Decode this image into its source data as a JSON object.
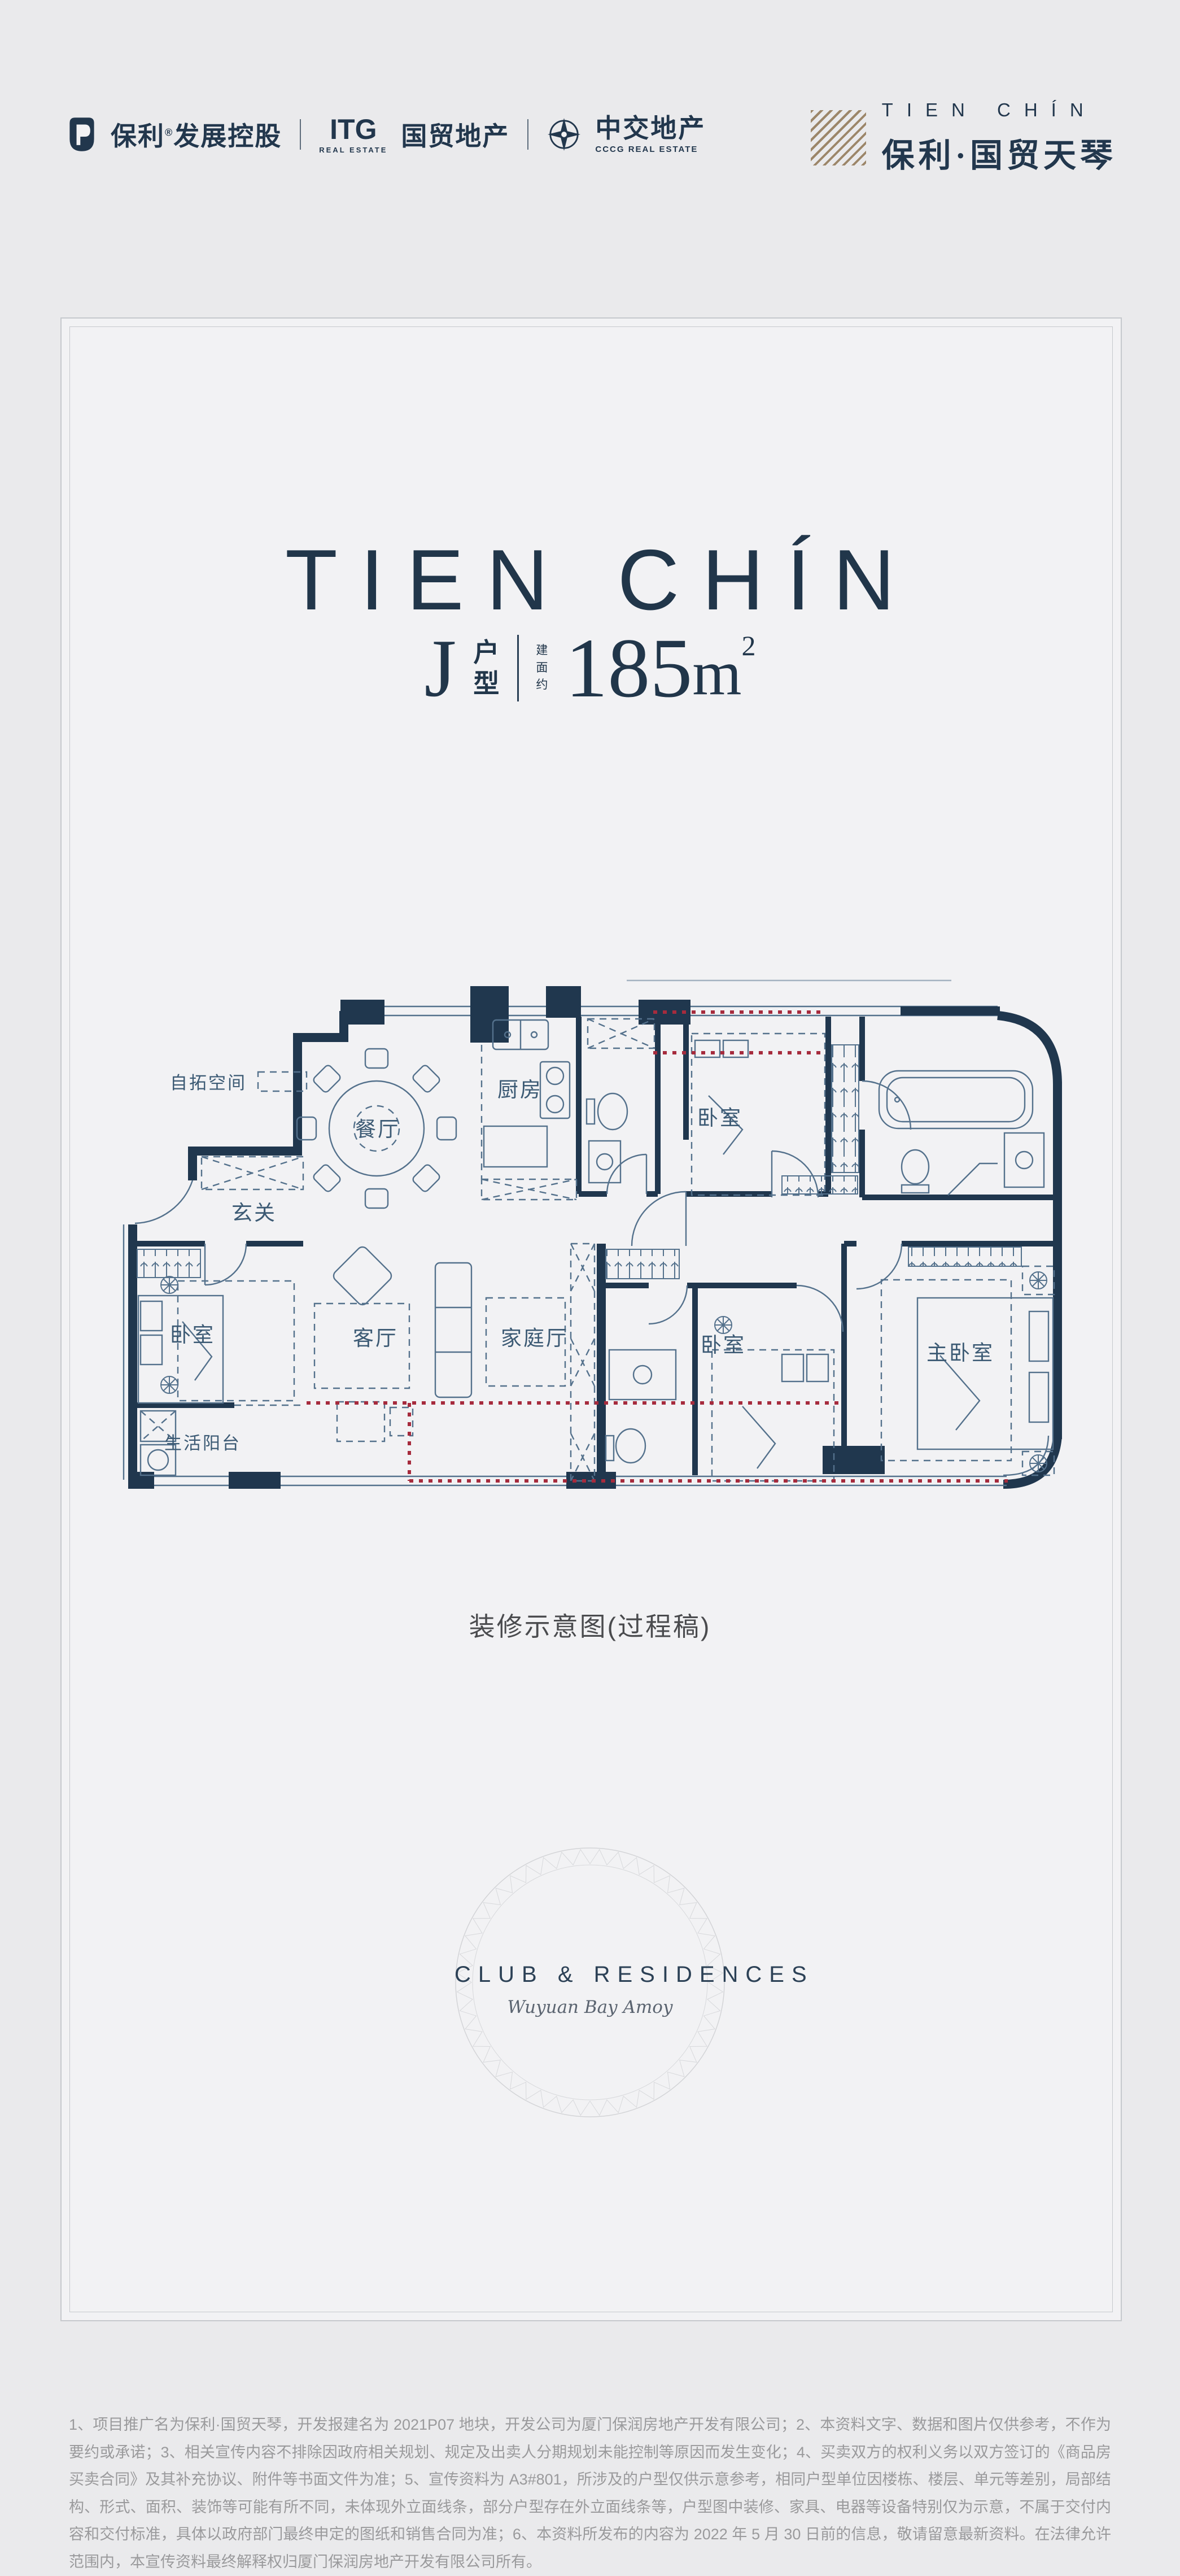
{
  "header": {
    "poly_group": {
      "brand": "保利",
      "reg": "®",
      "suffix": "发展控股"
    },
    "itg_group": {
      "acronym": "ITG",
      "acronym_sub": "REAL ESTATE",
      "name": "国贸地产"
    },
    "cccg_group": {
      "name": "中交地产",
      "sub": "CCCG REAL ESTATE"
    },
    "brand_right": {
      "en": "TIEN CHÍN",
      "cn": "保利·国贸天琴"
    }
  },
  "hero": {
    "title": "TIEN CHÍN",
    "unit_letter": "J",
    "unit_label_1": "户",
    "unit_label_2": "型",
    "area_note_1": "建",
    "area_note_2": "面",
    "area_note_3": "约",
    "area_number": "185",
    "area_unit": "m",
    "area_exp": "2"
  },
  "plan": {
    "caption": "装修示意图(过程稿)",
    "rooms": [
      {
        "key": "expand-space",
        "label": "自拓空间"
      },
      {
        "key": "foyer",
        "label": "玄关"
      },
      {
        "key": "dining",
        "label": "餐厅"
      },
      {
        "key": "kitchen",
        "label": "厨房"
      },
      {
        "key": "bedroom-2",
        "label": "卧室"
      },
      {
        "key": "bedroom-1",
        "label": "卧室"
      },
      {
        "key": "utility-balcony",
        "label": "生活阳台"
      },
      {
        "key": "living",
        "label": "客厅"
      },
      {
        "key": "family-room",
        "label": "家庭厅"
      },
      {
        "key": "bedroom-3",
        "label": "卧室"
      },
      {
        "key": "master-bedroom",
        "label": "主卧室"
      }
    ]
  },
  "emblem": {
    "title": "CLUB & RESIDENCES",
    "script": "Wuyuan Bay Amoy"
  },
  "footer": {
    "disclaimer": "1、项目推广名为保利·国贸天琴，开发报建名为 2021P07 地块，开发公司为厦门保润房地产开发有限公司；2、本资料文字、数据和图片仅供参考，不作为要约或承诺；3、相关宣传内容不排除因政府相关规划、规定及出卖人分期规划未能控制等原因而发生变化；4、买卖双方的权利义务以双方签订的《商品房买卖合同》及其补充协议、附件等书面文件为准；5、宣传资料为 A3#801，所涉及的户型仅供示意参考，相同户型单位因楼栋、楼层、单元等差别，局部结构、形式、面积、装饰等可能有所不同，未体现外立面线条，部分户型存在外立面线条等，户型图中装修、家具、电器等设备特别仅为示意，不属于交付内容和交付标准，具体以政府部门最终申定的图纸和销售合同为准；6、本资料所发布的内容为 2022 年 5 月 30 日前的信息，敬请留意最新资料。在法律允许范围内，本宣传资料最终解释权归厦门保润房地产开发有限公司所有。"
  },
  "colors": {
    "navy": "#21364a",
    "wall": "#20374e",
    "gold_hatch": "#9c8669",
    "red_line": "#a62b3d",
    "frame": "#c6c9cd",
    "disclaimer_gray": "#9a9a9c"
  }
}
